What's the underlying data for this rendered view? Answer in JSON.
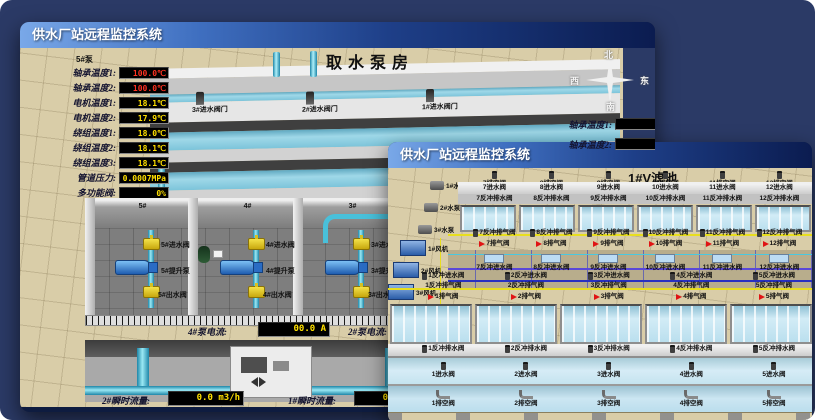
{
  "back_window": {
    "title": "供水厂站远程监控系统",
    "scene_title": "取水泵房",
    "panel": {
      "header": "5#泵",
      "rows": [
        {
          "label": "轴承温度1:",
          "value": "100.0℃",
          "color": "#ff3222"
        },
        {
          "label": "轴承温度2:",
          "value": "100.0℃",
          "color": "#ff3222"
        },
        {
          "label": "电机温度1:",
          "value": "18.1℃",
          "color": "#ffe000"
        },
        {
          "label": "电机温度2:",
          "value": "17.9℃",
          "color": "#ffe000"
        },
        {
          "label": "绕组温度1:",
          "value": "18.0℃",
          "color": "#ffe000"
        },
        {
          "label": "绕组温度2:",
          "value": "18.1℃",
          "color": "#ffe000"
        },
        {
          "label": "绕组温度3:",
          "value": "18.1℃",
          "color": "#ffe000"
        },
        {
          "label": "管道压力:",
          "value": "0.0007MPa",
          "color": "#ffe000"
        },
        {
          "label": "多功能阀:",
          "value": "0%",
          "color": "#ffe000"
        }
      ]
    },
    "inlet_gates": [
      "3#进水阀门",
      "2#进水阀门",
      "1#进水阀门"
    ],
    "compass": {
      "north": "北",
      "west": "西",
      "south": "南",
      "east": "东"
    },
    "side_readouts": [
      "轴承温度1:",
      "轴承温度2:"
    ],
    "pump_bays": [
      {
        "id": "5#",
        "inlet": "5#进水阀",
        "pump": "5#提升泵",
        "outlet": "5#出水阀"
      },
      {
        "id": "4#",
        "inlet": "4#进水阀",
        "pump": "4#提升泵",
        "outlet": "4#出水阀"
      },
      {
        "id": "3#",
        "inlet": "3#进水阀",
        "pump": "3#提升泵",
        "outlet": "3#出水阀"
      }
    ],
    "readouts": {
      "current_left_label": "4#泵电流:",
      "current_left_value": "00.0 A",
      "current_right_label": "2#泵电流:",
      "flow_left_label": "2#瞬时流量:",
      "flow_left_value": "0.0 m3/h",
      "flow_right_label": "1#瞬时流量:",
      "flow_right_value": "0.0 m3/h"
    }
  },
  "front_window": {
    "title": "供水厂站远程监控系统",
    "scene_title": "1#V滤池",
    "pumps": [
      "1#水泵",
      "2#水泵",
      "3#水泵"
    ],
    "blowers": [
      "1#风机",
      "2#风机",
      "3#风机"
    ],
    "rows": {
      "top_vent": [
        "7排空阀",
        "8排空阀",
        "9排空阀",
        "10排空阀",
        "11排空阀",
        "12排空阀"
      ],
      "top_inlet": [
        "7进水阀",
        "8进水阀",
        "9进水阀",
        "10进水阀",
        "11进水阀",
        "12进水阀"
      ],
      "top_bw_drain": [
        "7反冲排水阀",
        "8反冲排水阀",
        "9反冲排水阀",
        "10反冲排水阀",
        "11反冲排水阀",
        "12反冲排水阀"
      ],
      "top_bw_air": [
        "7反冲排气阀",
        "8反冲排气阀",
        "9反冲排气阀",
        "10反冲排气阀",
        "11反冲排气阀",
        "12反冲排气阀"
      ],
      "top_air": [
        "7排气阀",
        "8排气阀",
        "9排气阀",
        "10排气阀",
        "11排气阀",
        "12排气阀"
      ],
      "top_bw_inlet": [
        "7反冲进水阀",
        "8反冲进水阀",
        "9反冲进水阀",
        "10反冲进水阀",
        "11反冲进水阀",
        "12反冲进水阀"
      ],
      "bot_bw_inlet": [
        "1反冲进水阀",
        "2反冲进水阀",
        "3反冲进水阀",
        "4反冲进水阀",
        "5反冲进水阀",
        "6反冲进水阀"
      ],
      "bot_bw_air": [
        "1反冲排气阀",
        "2反冲排气阀",
        "3反冲排气阀",
        "4反冲排气阀",
        "5反冲排气阀",
        "6反冲排气阀"
      ],
      "bot_air": [
        "1排气阀",
        "2排气阀",
        "3排气阀",
        "4排气阀",
        "5排气阀",
        "6排气阀"
      ],
      "bot_bw_drain": [
        "1反冲排水阀",
        "2反冲排水阀",
        "3反冲排水阀",
        "4反冲排水阀",
        "5反冲排水阀",
        "6反冲排水阀"
      ],
      "bot_inlet": [
        "1进水阀",
        "2进水阀",
        "3进水阀",
        "4进水阀",
        "5进水阀",
        "6进水阀"
      ],
      "bot_vent": [
        "1排空阀",
        "2排空阀",
        "3排空阀",
        "4排空阀",
        "5排空阀",
        "6排空阀"
      ]
    }
  }
}
